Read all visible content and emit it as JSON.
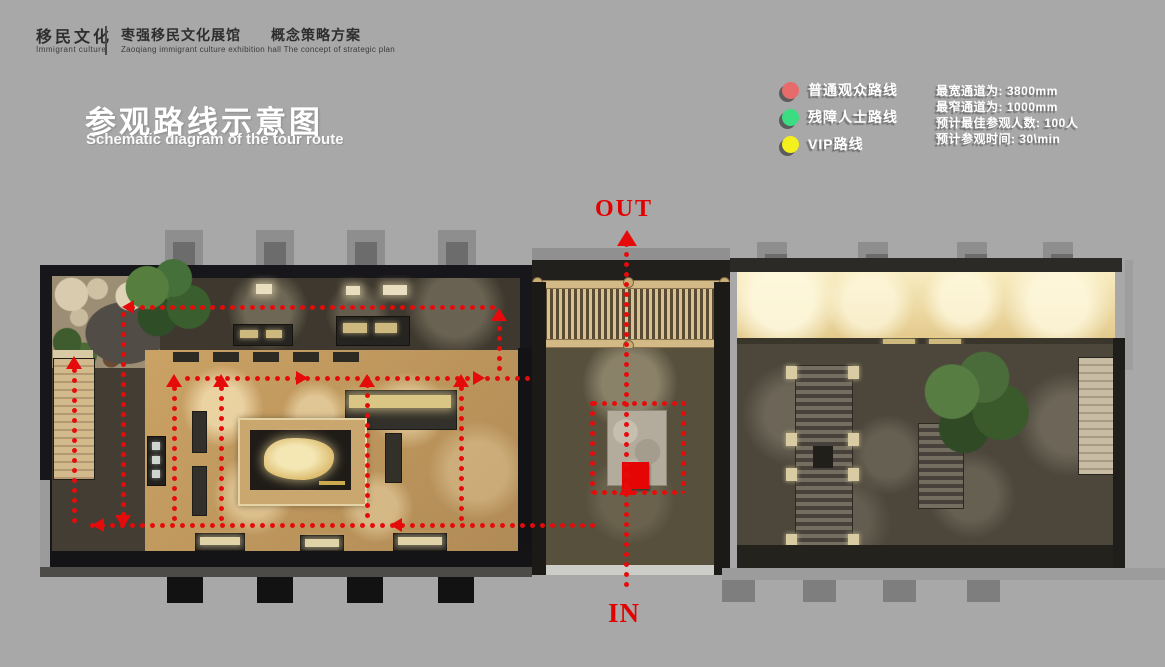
{
  "header": {
    "brand_zh": "移民文化",
    "brand_en": "Immigrant culture",
    "project_zh": "枣强移民文化展馆　　概念策略方案",
    "project_en": "Zaoqiang immigrant culture exhibition hall  The concept of strategic plan"
  },
  "title": {
    "zh": "参观路线示意图",
    "en": "Schematic diagram of the tour route"
  },
  "legend": {
    "items": [
      {
        "label": "普通观众路线",
        "color": "#e86b6b"
      },
      {
        "label": "残障人士路线",
        "color": "#3bdc82"
      },
      {
        "label": "VIP路线",
        "color": "#f4f01d"
      }
    ]
  },
  "stats": {
    "lines": [
      "最宽通道为: 3800mm",
      "最窄通道为: 1000mm",
      "预计最佳参观人数: 100人",
      "预计参观时间: 30\\min"
    ]
  },
  "plan": {
    "out_label": "OUT",
    "in_label": "IN",
    "route_color": "#e60b0b",
    "segments": [
      {
        "o": "h",
        "x": 92,
        "y": 77,
        "len": 368
      },
      {
        "o": "h",
        "x": 147,
        "y": 148,
        "len": 350
      },
      {
        "o": "h",
        "x": 52,
        "y": 295,
        "len": 508
      },
      {
        "o": "h",
        "x": 554,
        "y": 173,
        "len": 91
      },
      {
        "o": "h",
        "x": 554,
        "y": 262,
        "len": 91
      },
      {
        "o": "v",
        "x": 459,
        "y": 88,
        "len": 60
      },
      {
        "o": "v",
        "x": 34,
        "y": 140,
        "len": 157
      },
      {
        "o": "v",
        "x": 83,
        "y": 84,
        "len": 205
      },
      {
        "o": "v",
        "x": 134,
        "y": 158,
        "len": 137
      },
      {
        "o": "v",
        "x": 181,
        "y": 158,
        "len": 137
      },
      {
        "o": "v",
        "x": 327,
        "y": 155,
        "len": 140
      },
      {
        "o": "v",
        "x": 421,
        "y": 158,
        "len": 137
      },
      {
        "o": "v",
        "x": 586,
        "y": 14,
        "len": 350
      },
      {
        "o": "v",
        "x": 552,
        "y": 173,
        "len": 92
      },
      {
        "o": "v",
        "x": 643,
        "y": 173,
        "len": 92
      }
    ],
    "arrows": [
      {
        "x": 579,
        "y": 2,
        "dir": "up",
        "big": true
      },
      {
        "x": 84,
        "y": 72,
        "dir": "left"
      },
      {
        "x": 453,
        "y": 80,
        "dir": "up"
      },
      {
        "x": 258,
        "y": 143,
        "dir": "right"
      },
      {
        "x": 435,
        "y": 143,
        "dir": "right"
      },
      {
        "x": 128,
        "y": 146,
        "dir": "up"
      },
      {
        "x": 175,
        "y": 146,
        "dir": "up"
      },
      {
        "x": 321,
        "y": 146,
        "dir": "up"
      },
      {
        "x": 415,
        "y": 146,
        "dir": "up"
      },
      {
        "x": 28,
        "y": 128,
        "dir": "up"
      },
      {
        "x": 77,
        "y": 287,
        "dir": "down"
      },
      {
        "x": 54,
        "y": 290,
        "dir": "left"
      },
      {
        "x": 352,
        "y": 290,
        "dir": "left"
      },
      {
        "x": 581,
        "y": 254,
        "dir": "up"
      }
    ]
  }
}
